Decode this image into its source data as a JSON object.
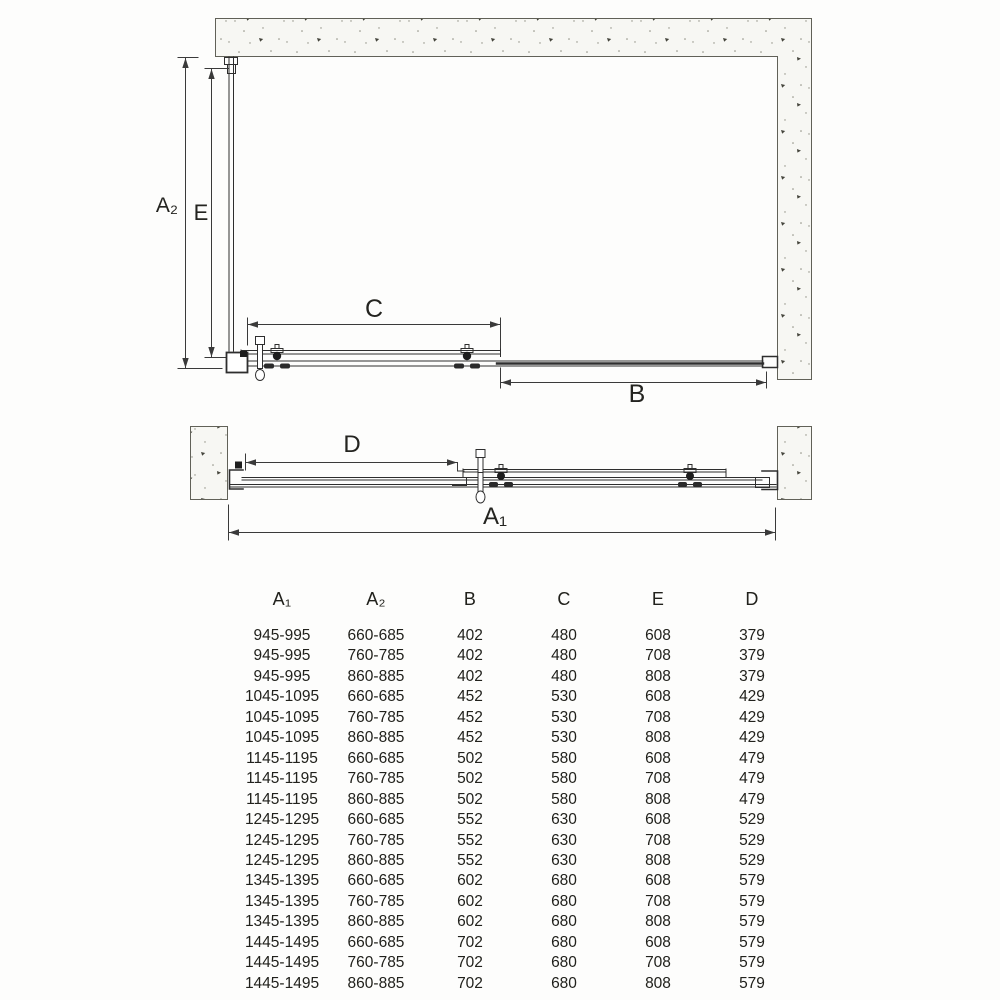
{
  "diagram": {
    "top_view": {
      "label_a2": "A₂",
      "label_e": "E",
      "label_c": "C",
      "label_b": "B"
    },
    "front_view": {
      "label_d": "D",
      "label_a1": "A₁"
    },
    "wall_fill": "#f7f7f3",
    "line_color": "#2e2e2e"
  },
  "table": {
    "headers": [
      "A₁",
      "A₂",
      "B",
      "C",
      "E",
      "D"
    ],
    "rows": [
      [
        "945-995",
        "660-685",
        "402",
        "480",
        "608",
        "379"
      ],
      [
        "945-995",
        "760-785",
        "402",
        "480",
        "708",
        "379"
      ],
      [
        "945-995",
        "860-885",
        "402",
        "480",
        "808",
        "379"
      ],
      [
        "1045-1095",
        "660-685",
        "452",
        "530",
        "608",
        "429"
      ],
      [
        "1045-1095",
        "760-785",
        "452",
        "530",
        "708",
        "429"
      ],
      [
        "1045-1095",
        "860-885",
        "452",
        "530",
        "808",
        "429"
      ],
      [
        "1145-1195",
        "660-685",
        "502",
        "580",
        "608",
        "479"
      ],
      [
        "1145-1195",
        "760-785",
        "502",
        "580",
        "708",
        "479"
      ],
      [
        "1145-1195",
        "860-885",
        "502",
        "580",
        "808",
        "479"
      ],
      [
        "1245-1295",
        "660-685",
        "552",
        "630",
        "608",
        "529"
      ],
      [
        "1245-1295",
        "760-785",
        "552",
        "630",
        "708",
        "529"
      ],
      [
        "1245-1295",
        "860-885",
        "552",
        "630",
        "808",
        "529"
      ],
      [
        "1345-1395",
        "660-685",
        "602",
        "680",
        "608",
        "579"
      ],
      [
        "1345-1395",
        "760-785",
        "602",
        "680",
        "708",
        "579"
      ],
      [
        "1345-1395",
        "860-885",
        "602",
        "680",
        "808",
        "579"
      ],
      [
        "1445-1495",
        "660-685",
        "702",
        "680",
        "608",
        "579"
      ],
      [
        "1445-1495",
        "760-785",
        "702",
        "680",
        "708",
        "579"
      ],
      [
        "1445-1495",
        "860-885",
        "702",
        "680",
        "808",
        "579"
      ]
    ]
  }
}
